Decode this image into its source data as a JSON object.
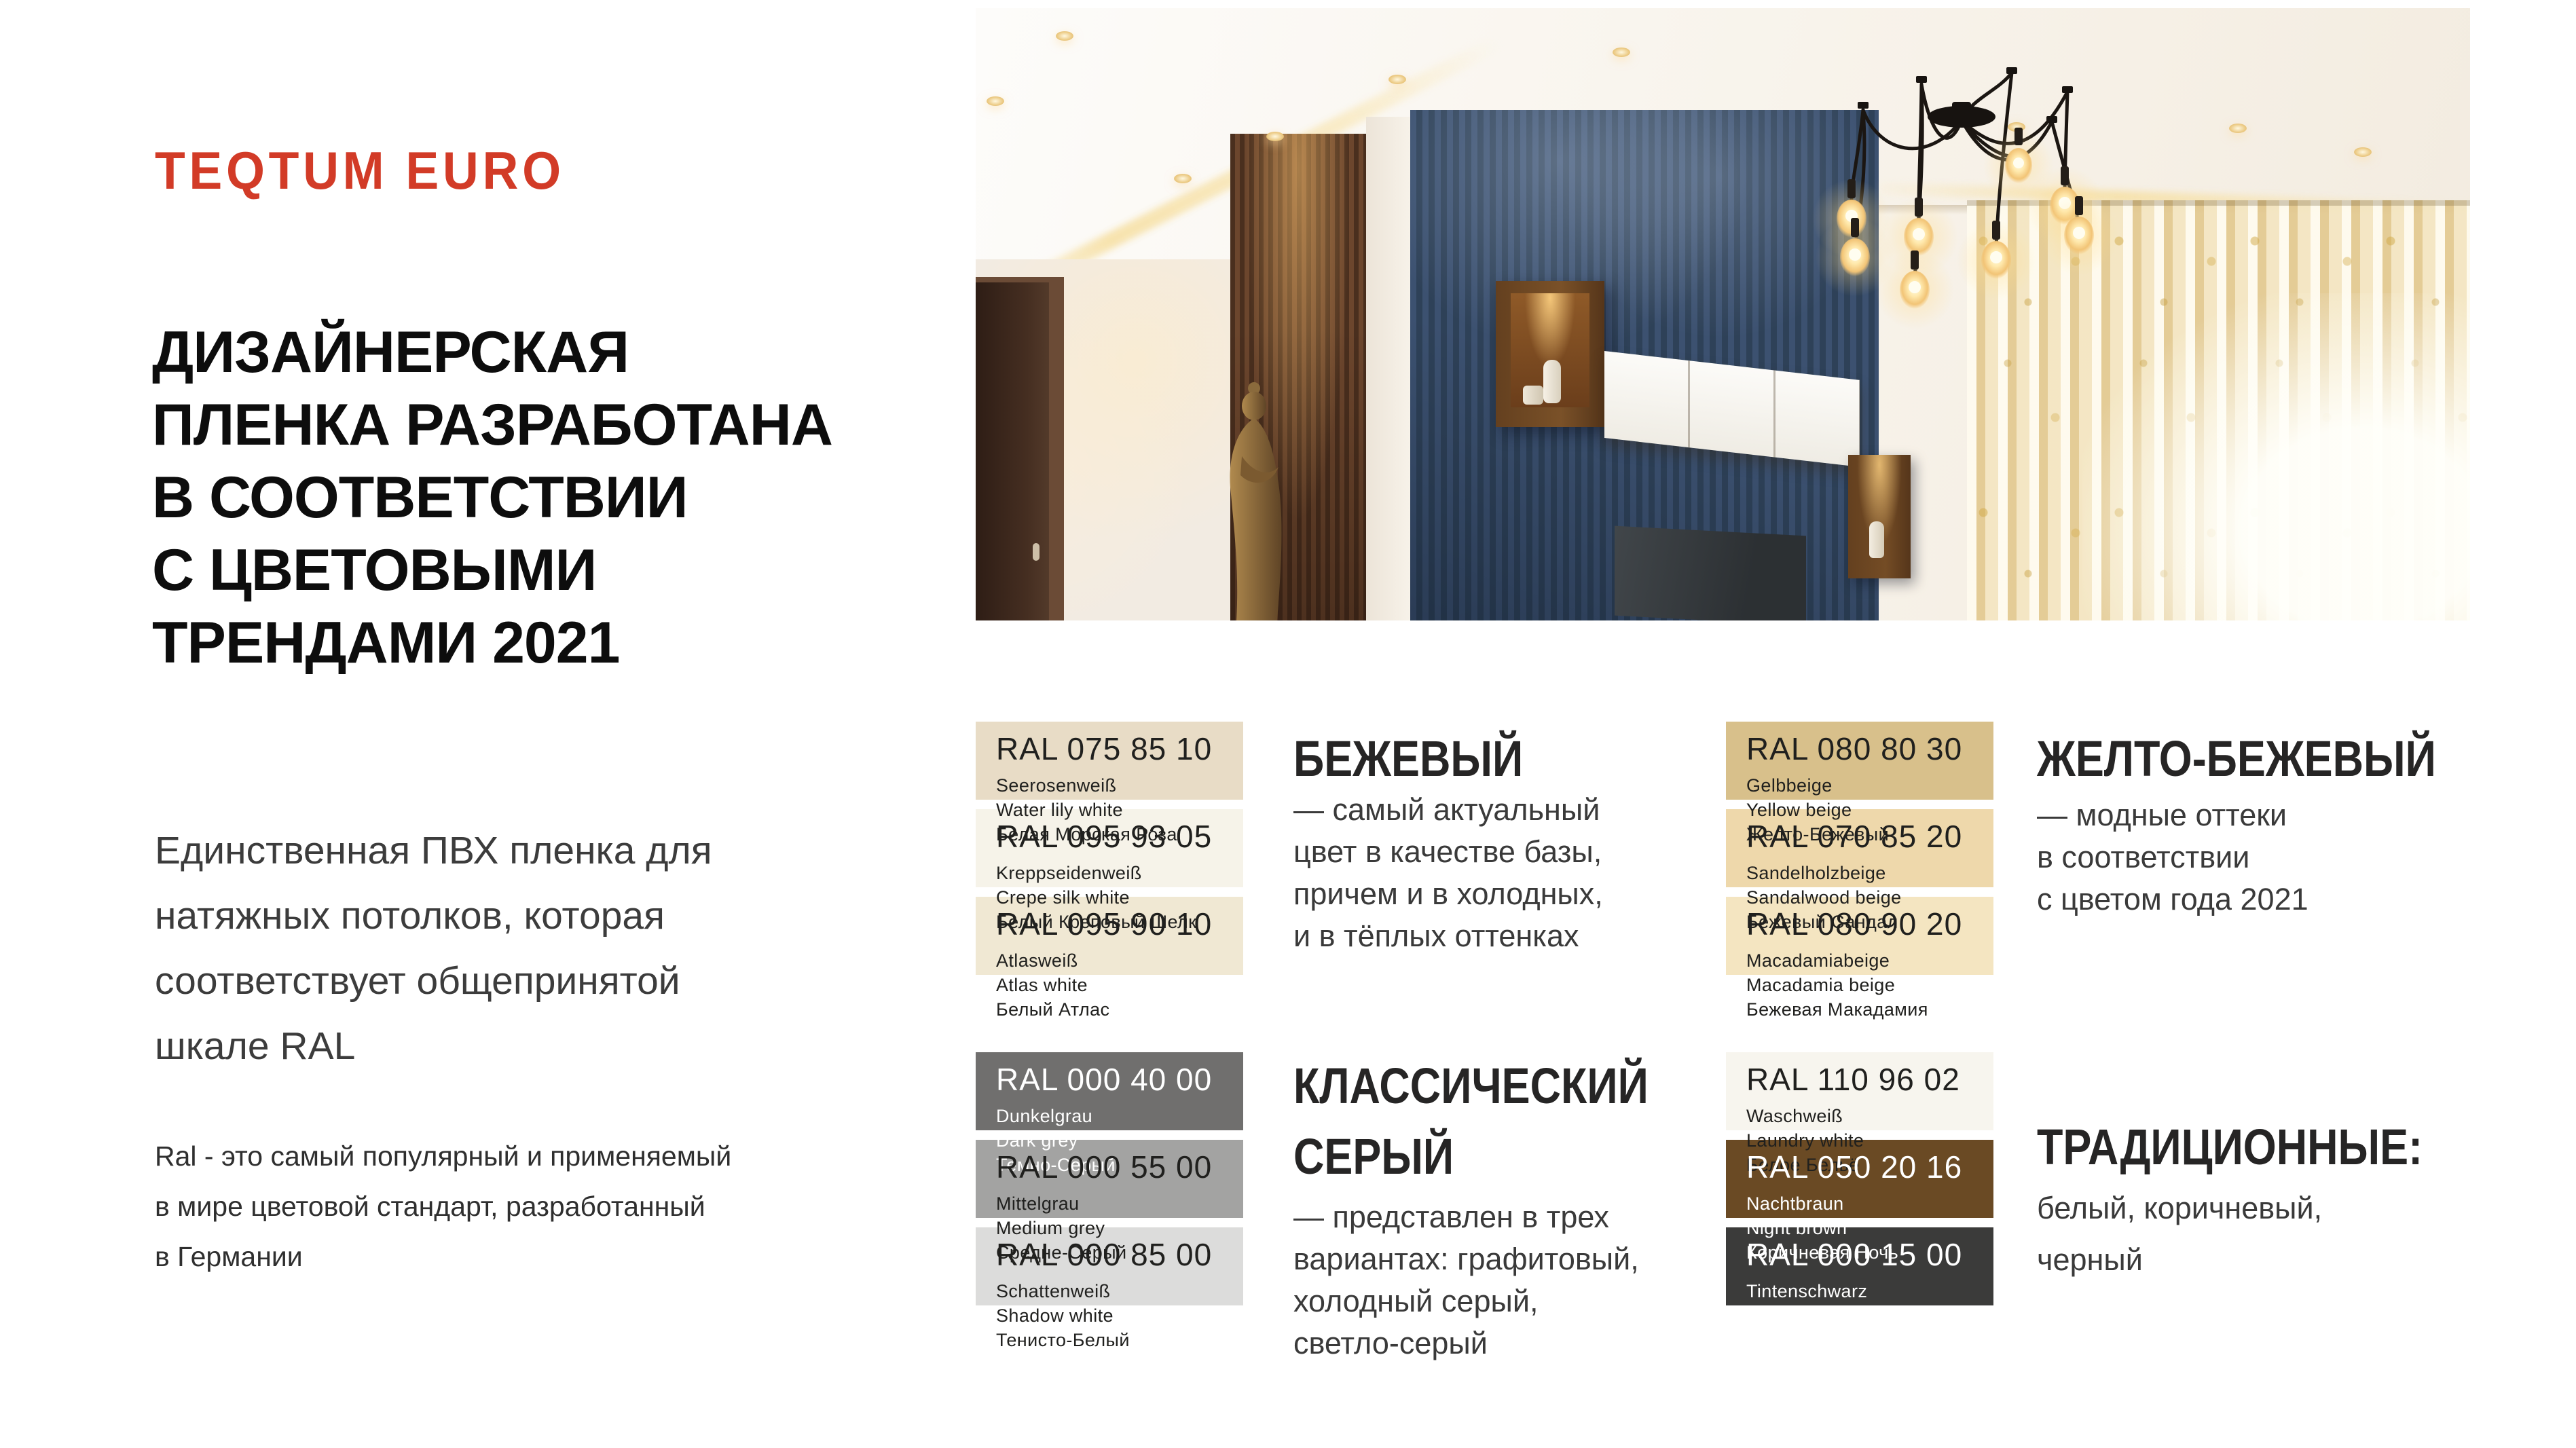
{
  "brand": {
    "name": "TEQTUM EURO",
    "accent": "#d23b27"
  },
  "headline": {
    "lines": [
      "ДИЗАЙНЕРСКАЯ",
      "ПЛЕНКА РАЗРАБОТАНА",
      "В СООТВЕТСТВИИ",
      "С ЦВЕТОВЫМИ",
      "ТРЕНДАМИ 2021"
    ]
  },
  "intro": "Единственная ПВХ пленка для\nнатяжных потолков,  которая\nсоответствует  общепринятой\nшкале RAL",
  "note": "Ral - это самый популярный и применяемый\nв мире цветовой стандарт,  разработанный\nв Германии",
  "sections": [
    {
      "heading": "БЕЖЕВЫЙ",
      "description": "— самый актуальный\nцвет в качестве базы,\nпричем и в холодных,\nи в тёплых оттенках",
      "swatches": [
        {
          "code": "RAL 075 85 10",
          "name_de": "Seerosenweiß",
          "name_en": "Water lily white",
          "name_ru": "Белая Морская Роза",
          "hex": "#e8dcc6",
          "text_color": "#20201e"
        },
        {
          "code": "RAL 095 93 05",
          "name_de": "Kreppseidenweiß",
          "name_en": "Crepe silk white",
          "name_ru": "Белый Креповый Шелк",
          "hex": "#f6f3e9",
          "text_color": "#20201e"
        },
        {
          "code": "RAL 095 90 10",
          "name_de": "Atlasweiß",
          "name_en": "Atlas white",
          "name_ru": "Белый Атлас",
          "hex": "#f0e8d3",
          "text_color": "#20201e"
        }
      ]
    },
    {
      "heading": "ЖЕЛТО-БЕЖЕВЫЙ",
      "description": "— модные оттеки\nв соответствии\nс цветом года 2021",
      "swatches": [
        {
          "code": "RAL 080 80 30",
          "name_de": "Gelbbeige",
          "name_en": "Yellow beige",
          "name_ru": "Желто-Бежевый",
          "hex": "#d8c08b",
          "text_color": "#20201e"
        },
        {
          "code": "RAL 070 85 20",
          "name_de": "Sandelholzbeige",
          "name_en": "Sandalwood beige",
          "name_ru": "Бежевый Сандал",
          "hex": "#eed8ab",
          "text_color": "#20201e"
        },
        {
          "code": "RAL 080 90 20",
          "name_de": "Macadamiabeige",
          "name_en": "Macadamia beige",
          "name_ru": "Бежевая Макадамия",
          "hex": "#f4e5c1",
          "text_color": "#20201e"
        }
      ]
    },
    {
      "heading": "КЛАССИЧЕСКИЙ\nСЕРЫЙ",
      "description": "— представлен в трех\nвариантах: графитовый,\nхолодный серый,\nсветло-серый",
      "swatches": [
        {
          "code": "RAL 000 40 00",
          "name_de": "Dunkelgrau",
          "name_en": "Dark grey",
          "name_ru": "Темно-Серый",
          "hex": "#706f6e",
          "text_color": "#ffffff"
        },
        {
          "code": "RAL 000 55 00",
          "name_de": "Mittelgrau",
          "name_en": "Medium grey",
          "name_ru": "Средне-Серый",
          "hex": "#a3a3a2",
          "text_color": "#20201e"
        },
        {
          "code": "RAL 000 85 00",
          "name_de": "Schattenweiß",
          "name_en": "Shadow white",
          "name_ru": "Тенисто-Белый",
          "hex": "#dcdcdb",
          "text_color": "#20201e"
        }
      ]
    },
    {
      "heading": "ТРАДИЦИОННЫЕ:",
      "description": "белый, коричневый,\nчерный",
      "swatches": [
        {
          "code": "RAL 110 96 02",
          "name_de": "Waschweiß",
          "name_en": "Laundry white",
          "name_ru": "Белое Бельё",
          "hex": "#f7f5ee",
          "text_color": "#20201e"
        },
        {
          "code": "RAL 050 20 16",
          "name_de": "Nachtbraun",
          "name_en": "Night brown",
          "name_ru": "Коричневая Ночь",
          "hex": "#6a4a24",
          "text_color": "#ffffff"
        },
        {
          "code": "RAL 000 15 00",
          "name_de": "Tintenschwarz",
          "name_en": "Ink black",
          "name_ru": "Чернильно-Черный",
          "hex": "#3b3b3a",
          "text_color": "#ffffff"
        }
      ]
    }
  ]
}
